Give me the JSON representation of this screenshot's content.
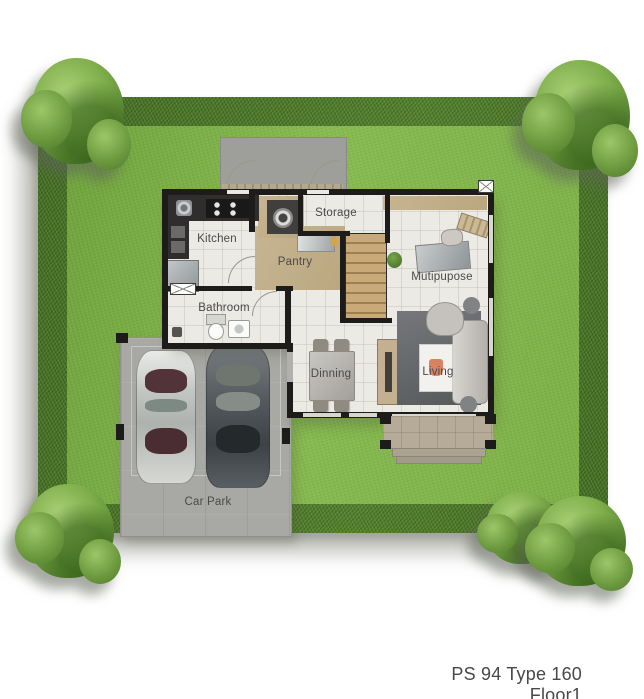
{
  "plan_title": "PS 94 Type 160 Floor1",
  "rooms": {
    "kitchen": "Kitchen",
    "pantry": "Pantry",
    "storage": "Storage",
    "bathroom": "Bathroom",
    "dinning": "Dinning",
    "mutipupose": "Mutipupose",
    "living": "Living",
    "car_park": "Car Park"
  },
  "colors": {
    "lawn": "#7db046",
    "hedge": "#456e27",
    "floor": "#eceae5",
    "tan": "#c7b593",
    "wall": "#1d1c1a",
    "carpark": "#a8a8a4",
    "porch": "#b6aa99",
    "label": "#4a4a4a"
  },
  "icons": [
    "tree",
    "hedge",
    "lawn",
    "car",
    "stove-icon",
    "sink-icon",
    "refrigerator-icon",
    "washing-machine-icon",
    "stairs",
    "toilet-icon",
    "washbasin-icon",
    "dining-table",
    "chair-icon",
    "cabinet",
    "sofa",
    "armchair",
    "coffee-table",
    "ottoman-icon",
    "desk",
    "office-chair-icon",
    "wall-shelf-icon",
    "plant-icon",
    "window-icon",
    "ac-unit-icon",
    "porch-steps",
    "door-arc"
  ]
}
